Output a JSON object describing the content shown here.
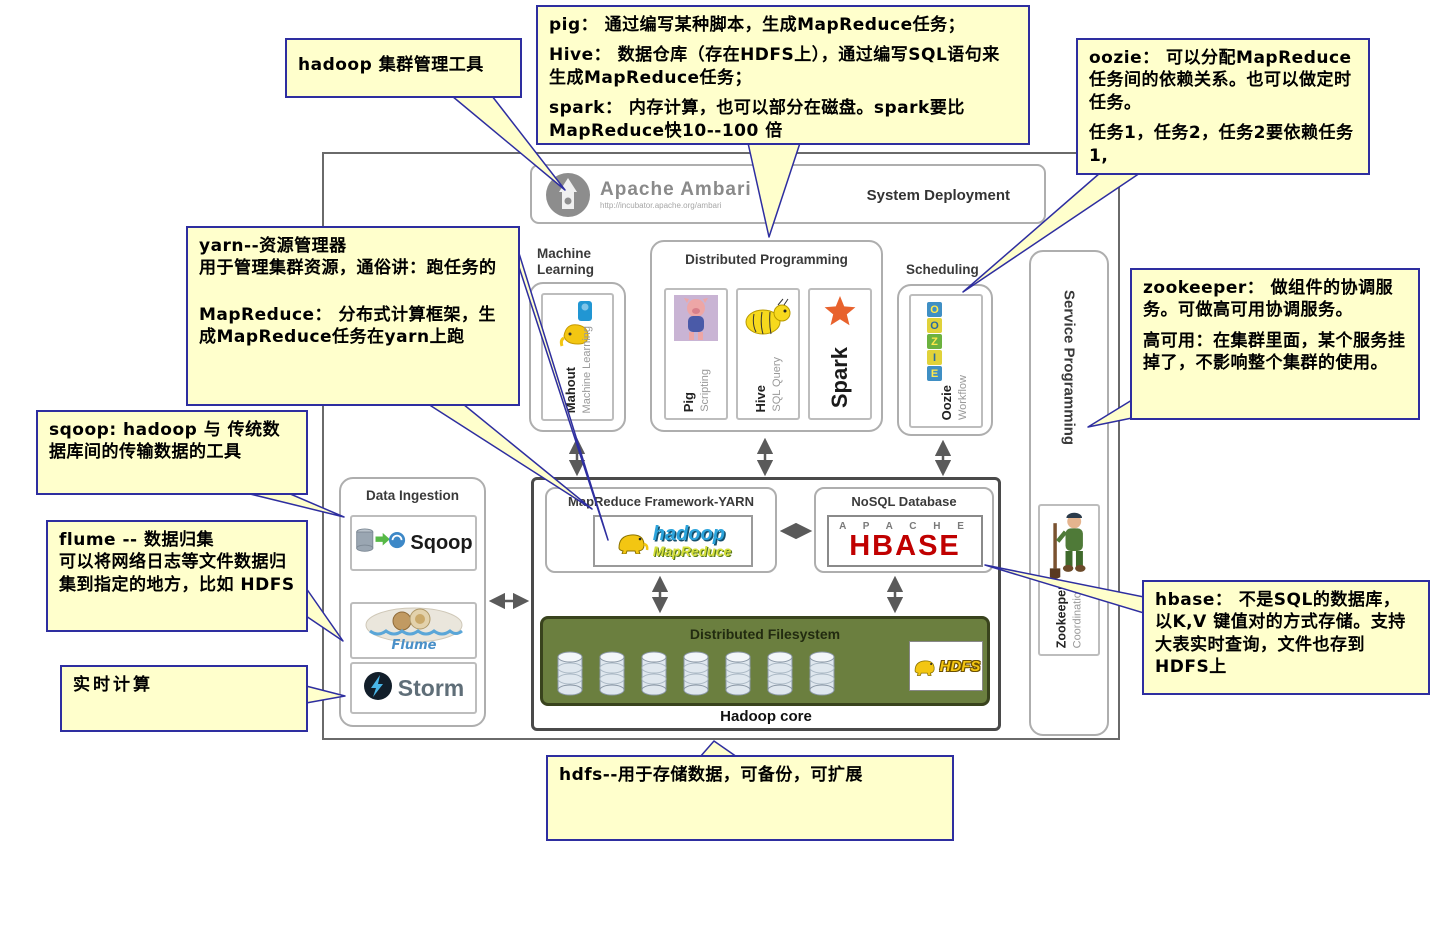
{
  "colors": {
    "callout_bg": "#ffffcc",
    "callout_border": "#2e2ea0",
    "green_box": "#6b7f3f",
    "hbase_red": "#c00000",
    "spark_orange": "#e8622d",
    "arrow_gray": "#5a5a5a"
  },
  "callouts": {
    "ambari": {
      "text": "hadoop 集群管理工具"
    },
    "compute": {
      "line1": "pig： 通过编写某种脚本，生成MapReduce任务；",
      "line2": "Hive： 数据仓库（存在HDFS上），通过编写SQL语句来生成MapReduce任务；",
      "line3": "spark： 内存计算，也可以部分在磁盘。spark要比MapReduce快10--100 倍"
    },
    "oozie": {
      "line1": "oozie： 可以分配MapReduce任务间的依赖关系。也可以做定时任务。",
      "line2": "任务1，任务2，任务2要依赖任务1,"
    },
    "yarn": {
      "line1": "yarn--资源管理器",
      "line2": "用于管理集群资源，通俗讲：跑任务的",
      "line3": "MapReduce： 分布式计算框架，生成MapReduce任务在yarn上跑"
    },
    "sqoop": {
      "text": "sqoop: hadoop 与 传统数据库间的传输数据的工具"
    },
    "flume": {
      "line1": "flume -- 数据归集",
      "line2": "可以将网络日志等文件数据归集到指定的地方，比如 HDFS"
    },
    "realtime": {
      "text": "实时计算"
    },
    "zookeeper": {
      "line1": "zookeeper： 做组件的协调服务。可做高可用协调服务。",
      "line2": "高可用：在集群里面，某个服务挂掉了，不影响整个集群的使用。"
    },
    "hbase": {
      "text": "hbase： 不是SQL的数据库，以K,V 键值对的方式存储。支持大表实时查询，文件也存到HDFS上"
    },
    "hdfs": {
      "text": "hdfs--用于存储数据，可备份，可扩展"
    }
  },
  "diagram": {
    "ambari": {
      "title": "Apache Ambari",
      "url": "http://incubator.apache.org/ambari",
      "right_label": "System Deployment"
    },
    "machine_learning": {
      "label": "Machine Learning",
      "item": "Mahout",
      "item_sub": "Machine Learning"
    },
    "distributed_programming": {
      "label": "Distributed Programming",
      "pig": "Pig",
      "pig_sub": "Scripting",
      "hive": "Hive",
      "hive_sub": "SQL Query",
      "spark": "Spark"
    },
    "scheduling": {
      "label": "Scheduling",
      "item": "Oozie",
      "item_sub": "Workflow",
      "letters": [
        "O",
        "O",
        "Z",
        "I",
        "E"
      ]
    },
    "service_programming": {
      "label": "Service Programming"
    },
    "zookeeper": {
      "item": "Zookeeper",
      "item_sub": "Coordination"
    },
    "data_ingestion": {
      "label": "Data Ingestion",
      "sqoop": "Sqoop",
      "flume": "Flume",
      "storm": "Storm"
    },
    "mapreduce": {
      "label": "MapReduce Framework-YARN",
      "logo_top": "hadoop",
      "logo_bottom": "MapReduce"
    },
    "nosql": {
      "label": "NoSQL Database",
      "logo_top": "A P A C H E",
      "logo_main": "HBASE"
    },
    "dfs": {
      "label": "Distributed Filesystem",
      "hdfs": "HDFS"
    },
    "core_label": "Hadoop core"
  }
}
